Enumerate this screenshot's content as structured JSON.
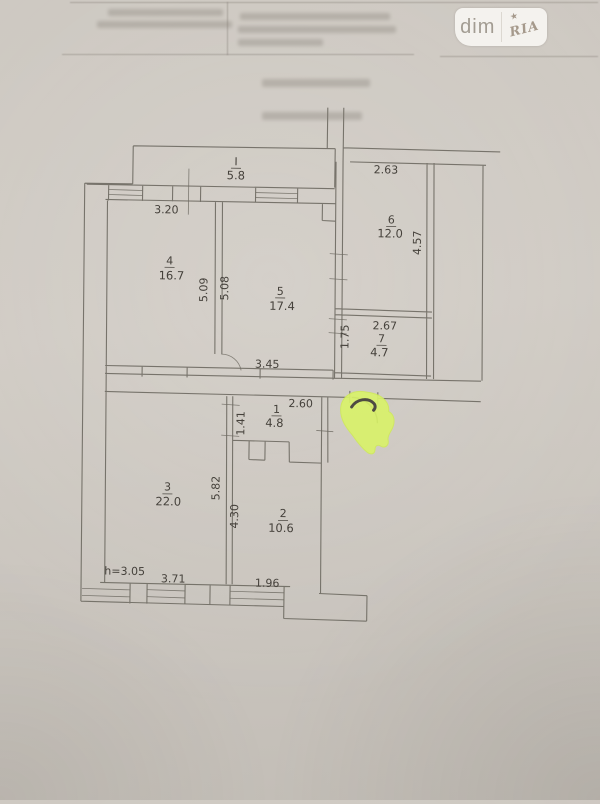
{
  "watermark": {
    "left": "dim",
    "right": "RIA",
    "star_icon": "★"
  },
  "plan": {
    "rooms": {
      "balcony": {
        "number": "I",
        "area": "5.8"
      },
      "room4": {
        "number": "4",
        "area": "16.7"
      },
      "room5": {
        "number": "5",
        "area": "17.4"
      },
      "room6": {
        "number": "6",
        "area": "12.0"
      },
      "room7": {
        "number": "7",
        "area": "4.7"
      },
      "room1": {
        "number": "1",
        "area": "4.8"
      },
      "room2": {
        "number": "2",
        "area": "10.6"
      },
      "room3": {
        "number": "3",
        "area": "22.0"
      }
    },
    "dims": {
      "top_room4": "3.20",
      "room4_right_v": "5.09",
      "room5_left_v": "5.08",
      "room6_top": "2.63",
      "room6_right_v": "4.57",
      "room7_top": "2.67",
      "room7_left_v": "1.75",
      "corridor": "3.45",
      "room1_top": "2.60",
      "room1_left_v": "1.41",
      "wall32_upper_v": "5.82",
      "wall32_lower_v": "4.30",
      "ceiling_height": "h=3.05",
      "room3_bottom": "3.71",
      "room2_bottom": "1.96"
    }
  },
  "colors": {
    "paper": "#cbc6bf",
    "plan_lines": "#6f6b63",
    "labels": "#45413b",
    "highlighter": "#d9f26a",
    "badge_bg": "#f4f2ee"
  }
}
